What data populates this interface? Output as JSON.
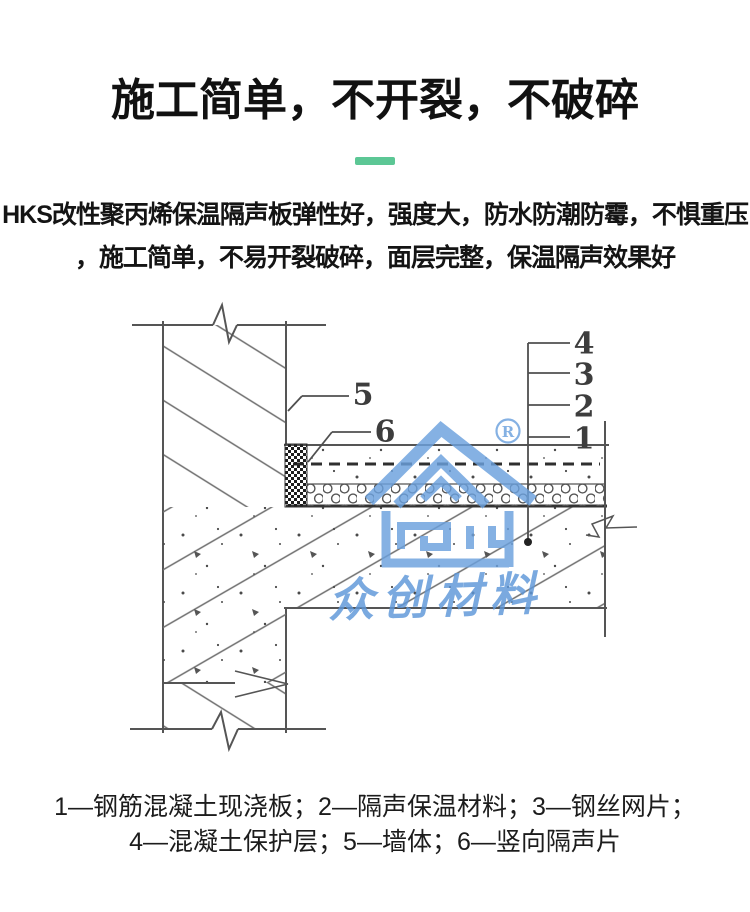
{
  "page": {
    "background": "#ffffff",
    "accent_green": "#5cc795"
  },
  "header": {
    "title": "施工简单，不开裂，不破碎",
    "divider_color": "#5cc795"
  },
  "intro": {
    "line1": "HKS改性聚丙烯保温隔声板弹性好，强度大，防水防潮防霉，不惧重压",
    "line2": "，施工简单，不易开裂破碎，面层完整，保温隔声效果好"
  },
  "diagram": {
    "type": "construction-detail-section",
    "callouts": [
      {
        "num": "4",
        "target": "混凝土保护层"
      },
      {
        "num": "3",
        "target": "钢丝网片"
      },
      {
        "num": "2",
        "target": "隔声保温材料"
      },
      {
        "num": "1",
        "target": "钢筋混凝土现浇板"
      },
      {
        "num": "5",
        "target": "墙体"
      },
      {
        "num": "6",
        "target": "竖向隔声片"
      }
    ],
    "line_color": "#555555"
  },
  "watermark": {
    "registered_mark": "R",
    "text": "众创材料",
    "logo": "house-logo",
    "color_logo": "#6ba1de",
    "color_text": "#5e97d9"
  },
  "legend": {
    "line1": "1—钢筋混凝土现浇板；2—隔声保温材料；3—钢丝网片；",
    "line2": "4—混凝土保护层；5—墙体；6—竖向隔声片",
    "items": [
      {
        "num": "1",
        "label": "钢筋混凝土现浇板"
      },
      {
        "num": "2",
        "label": "隔声保温材料"
      },
      {
        "num": "3",
        "label": "钢丝网片"
      },
      {
        "num": "4",
        "label": "混凝土保护层"
      },
      {
        "num": "5",
        "label": "墙体"
      },
      {
        "num": "6",
        "label": "竖向隔声片"
      }
    ]
  }
}
